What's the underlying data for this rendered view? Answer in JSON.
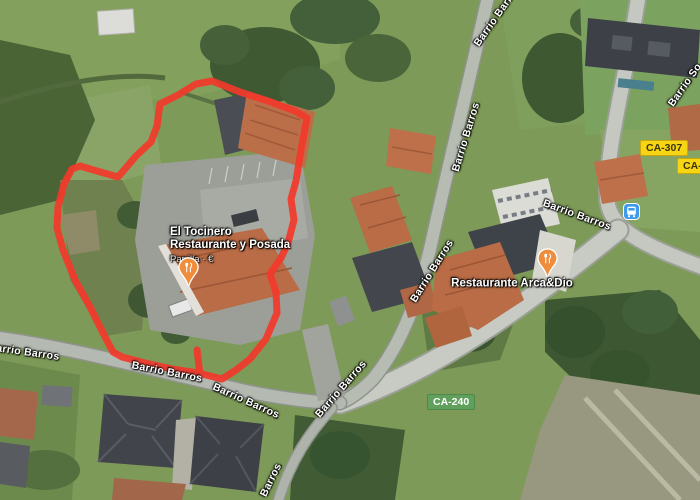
{
  "poi": {
    "tocinero": {
      "line1": "El Tocinero",
      "line2": "Restaurante y Posada",
      "subtitle": "Parrilla · €",
      "pin_icon": "restaurant-pin",
      "pin_color": "#ef8d3c"
    },
    "arcadio": {
      "name": "Restaurante Arca&Dio",
      "pin_icon": "restaurant-pin",
      "pin_color": "#ef8d3c"
    }
  },
  "streets": {
    "main": "Barrio Barros",
    "partial_so": "Barrio So",
    "short": "Barros"
  },
  "badges": {
    "ca307": {
      "label": "CA-307",
      "color": "#f7d414",
      "text_color": "#3a3607"
    },
    "ca2": {
      "label": "CA-2",
      "color": "#f7d414",
      "text_color": "#3a3607"
    },
    "ca240": {
      "label": "CA-240",
      "color": "#61a05c",
      "text_color": "#ffffff"
    }
  },
  "transit": {
    "bus_stop_icon": "bus-stop-icon",
    "bus_stop_color": "#3d9bea"
  },
  "annotation": {
    "type": "hand-drawn property outline",
    "color": "#f2392b"
  }
}
